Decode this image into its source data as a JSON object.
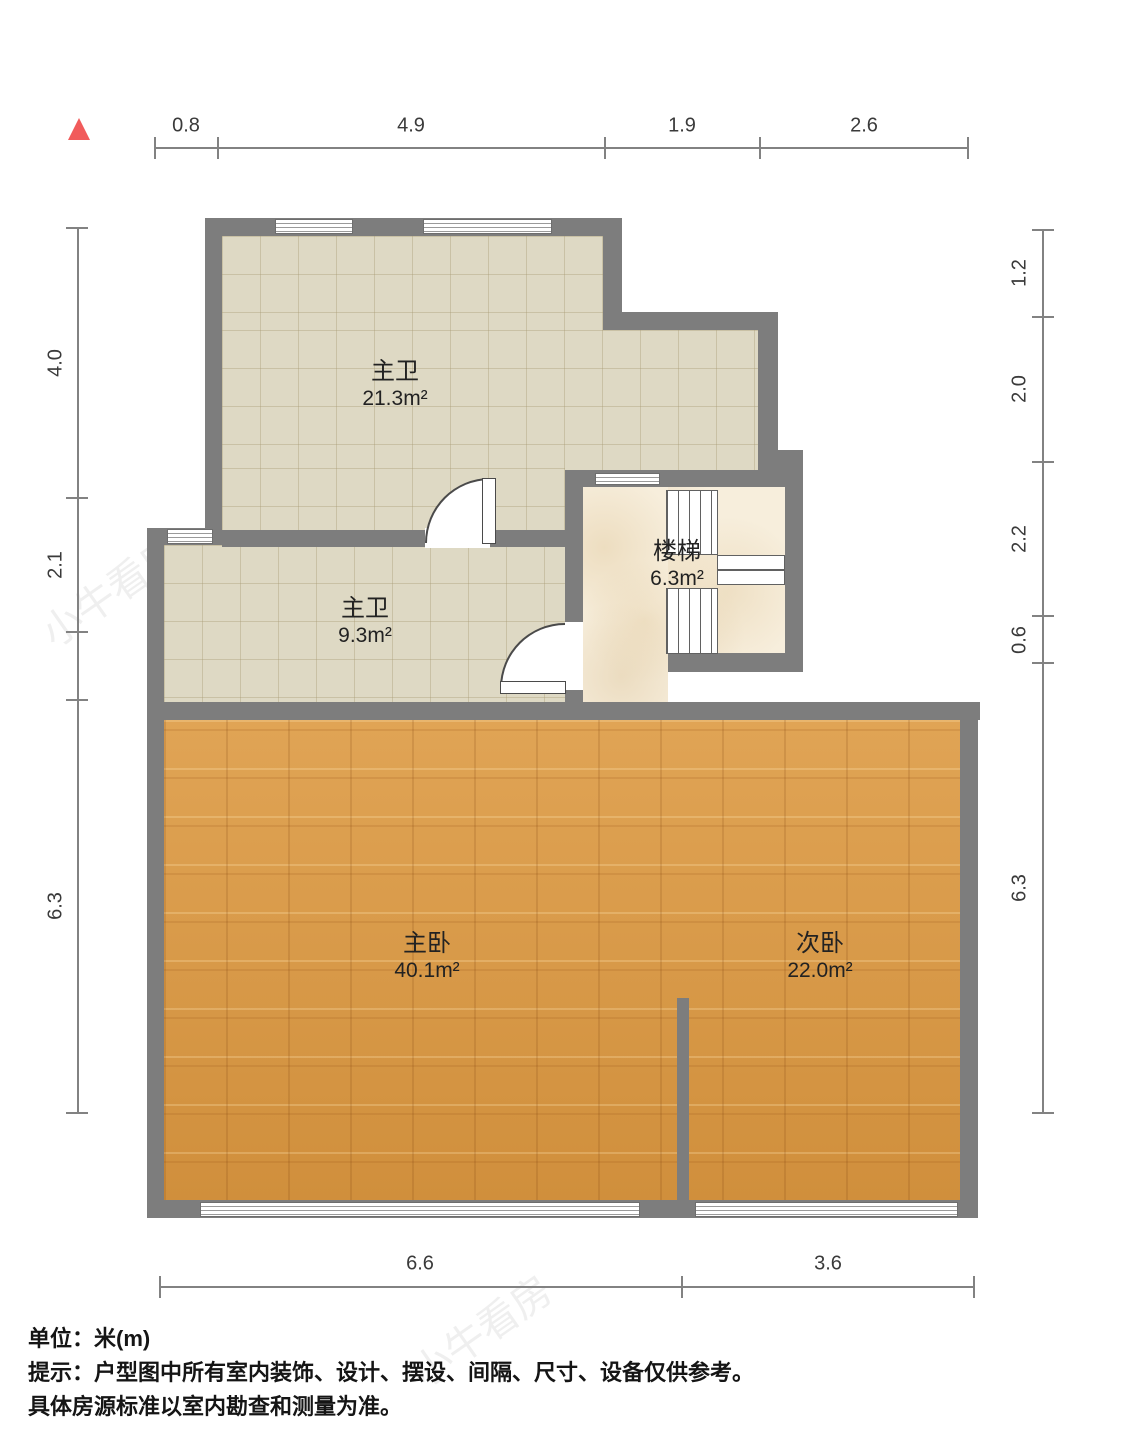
{
  "rooms": [
    {
      "name": "主卫",
      "area": "21.3m²"
    },
    {
      "name": "主卫",
      "area": "9.3m²"
    },
    {
      "name": "楼梯",
      "area": "6.3m²"
    },
    {
      "name": "主卧",
      "area": "40.1m²"
    },
    {
      "name": "次卧",
      "area": "22.0m²"
    }
  ],
  "dimensions": {
    "top": [
      "0.8",
      "4.9",
      "1.9",
      "2.6"
    ],
    "left": [
      "4.0",
      "2.1",
      "6.3"
    ],
    "right": [
      "1.2",
      "2.0",
      "2.2",
      "0.6",
      "6.3"
    ],
    "bottom": [
      "6.6",
      "3.6"
    ]
  },
  "footer": {
    "line1_label": "单位：",
    "line1_value": "米(m)",
    "line2": "提示：户型图中所有室内装饰、设计、摆设、间隔、尺寸、设备仅供参考。",
    "line3": "具体房源标准以室内勘查和测量为准。"
  },
  "watermark": "小牛看房",
  "colors": {
    "wall": "#7d7d7d",
    "tile_floor": "#ded9c4",
    "marble_floor": "#f7eedc",
    "wood_floor": "#d6973f",
    "north_marker": "#f15b5b",
    "dimension_line": "#828282"
  }
}
